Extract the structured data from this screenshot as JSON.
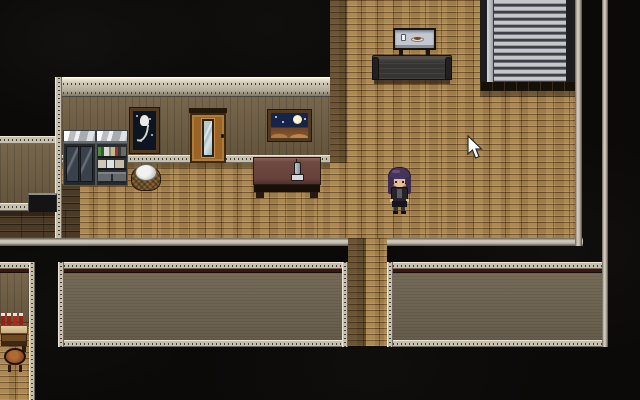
{
  "scene": {
    "title": "Top-down pixel-art RPG interior at night",
    "style": "2D RPG Maker style room with wooden floors and dark void",
    "palette": {
      "background": "#0b0a09",
      "floor_wood": "#a7834e",
      "floor_dark_planks": "#4a3a26",
      "wall_upper": "#6f5e44",
      "wall_lower": "#6e6450",
      "trim": "#c6bfae",
      "trim_red_line": "#3c1712",
      "shutter_light": "#c6c7cb",
      "shutter_dark": "#3f3f47",
      "bottle_red": "#9c1f15",
      "hair_purple": "#46345c"
    }
  },
  "objects": {
    "glass_cabinet": {
      "label": "Glass display cabinet"
    },
    "bookshelf": {
      "label": "Shelf with books, boxes and drawers"
    },
    "laundry_basket": {
      "label": "Wicker basket with white cloth"
    },
    "tulip_painting": {
      "label": "Dark painting of a white tulip"
    },
    "door": {
      "label": "Wooden door with glass panel"
    },
    "night_painting": {
      "label": "Night sky painting with moon"
    },
    "desk": {
      "label": "Maroon desk"
    },
    "telephone": {
      "label": "Cordless telephone"
    },
    "display_case": {
      "label": "Wall display case with cup and plate"
    },
    "sofa": {
      "label": "Dark sofa bench"
    },
    "shutter": {
      "label": "Metal roller shutter"
    },
    "counter": {
      "label": "Dark counter"
    },
    "bottle_table": {
      "label": "Table with red bottles"
    },
    "stool": {
      "label": "Round wooden stool"
    },
    "player": {
      "label": "Purple-haired character facing south"
    },
    "cursor": {
      "label": "Mouse pointer"
    }
  }
}
